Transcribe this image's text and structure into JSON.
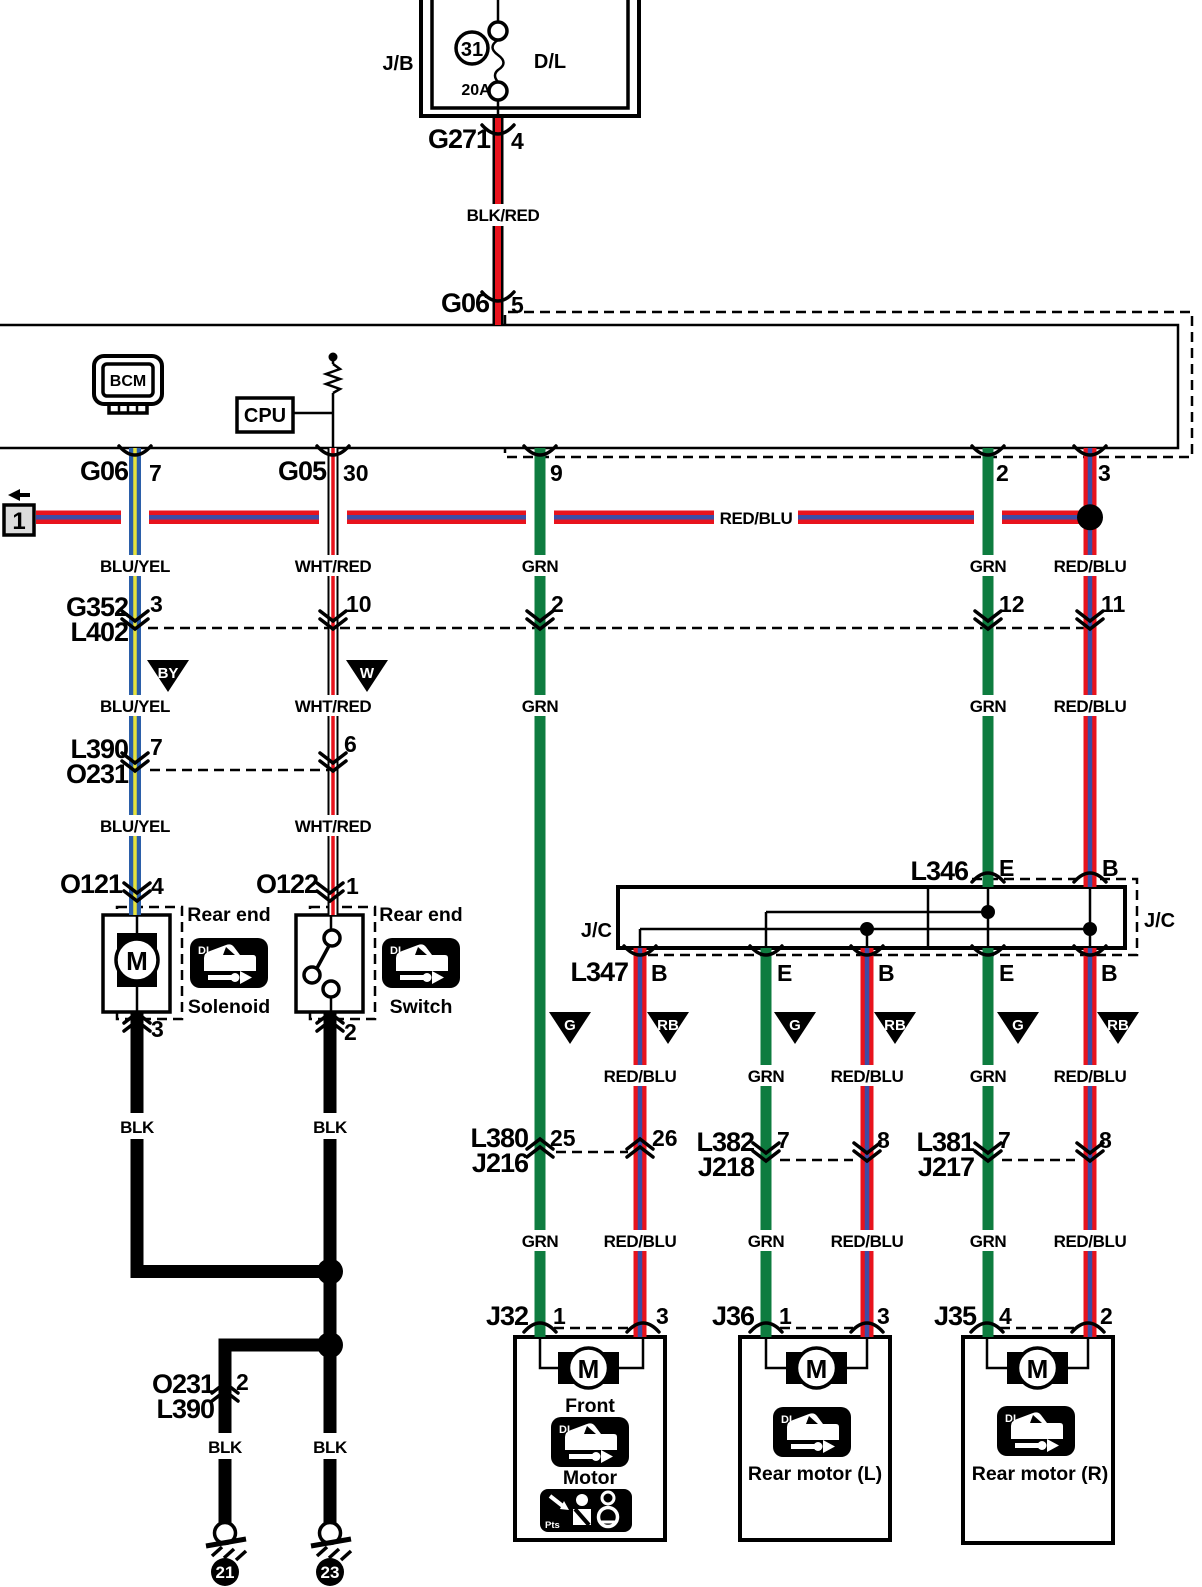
{
  "colors": {
    "green": "#0e7c3f",
    "red": "#e8131d",
    "blue_stripe": "#3c4da6",
    "blue": "#2b5fa9",
    "yellow": "#e7e33b",
    "ref_box_fill": "#dcdcdc"
  },
  "wires": {
    "blk_red": "BLK/RED",
    "blu_yel": "BLU/YEL",
    "wht_red": "WHT/RED",
    "grn": "GRN",
    "red_blu": "RED/BLU",
    "blk": "BLK"
  },
  "codes": {
    "by": "BY",
    "w": "W",
    "g": "G",
    "rb": "RB"
  },
  "fuse_panel": {
    "panel": "J/B",
    "fuse_number": "31",
    "rating": "20A",
    "circuit": "D/L"
  },
  "feed": {
    "connector_top": "G271",
    "pin_top": "4",
    "connector_bottom": "G06",
    "pin_bottom": "5"
  },
  "bcm": {
    "module": "BCM",
    "cpu": "CPU"
  },
  "bcm_pins": {
    "g06": "G06",
    "g06_pin": "7",
    "g05": "G05",
    "g05_pin": "30",
    "pin_9": "9",
    "pin_2": "2",
    "pin_3": "3"
  },
  "bus": {
    "ref": "1"
  },
  "conn_g352": {
    "row1": "G352",
    "row2": "L402",
    "pins": [
      "3",
      "10",
      "2",
      "12",
      "11"
    ]
  },
  "conn_l390": {
    "row1": "L390",
    "row2": "O231",
    "pins": [
      "7",
      "6"
    ]
  },
  "solenoid": {
    "connector": "O121",
    "pin_in": "4",
    "pin_out": "3",
    "motor": "M",
    "caption_top": "Rear end",
    "caption_bottom": "Solenoid",
    "dl": "DL"
  },
  "door_switch": {
    "connector": "O122",
    "pin_in": "1",
    "pin_out": "2",
    "caption_top": "Rear end",
    "caption_bottom": "Switch",
    "dl": "DL"
  },
  "junction": {
    "top": "L346",
    "bottom": "L347",
    "jc_left": "J/C",
    "jc_right": "J/C",
    "pins_top": [
      "E",
      "B"
    ],
    "pins_bottom": [
      "B",
      "E",
      "B",
      "E",
      "B"
    ]
  },
  "conn_l380": {
    "row1": "L380",
    "row2": "J216",
    "pins": [
      "25",
      "26"
    ]
  },
  "conn_l382": {
    "row1": "L382",
    "row2": "J218",
    "pins": [
      "7",
      "8"
    ]
  },
  "conn_l381": {
    "row1": "L381",
    "row2": "J217",
    "pins": [
      "7",
      "8"
    ]
  },
  "front_motor": {
    "connector": "J32",
    "pin_left": "1",
    "pin_right": "3",
    "motor": "M",
    "caption1": "Front",
    "caption2": "Motor",
    "dl": "DL",
    "icon_text": "Pts"
  },
  "rear_motor_l": {
    "connector": "J36",
    "pin_left": "1",
    "pin_right": "3",
    "motor": "M",
    "caption": "Rear motor (L)",
    "dl": "DL"
  },
  "rear_motor_r": {
    "connector": "J35",
    "pin_left": "4",
    "pin_right": "2",
    "motor": "M",
    "caption": "Rear motor (R)",
    "dl": "DL"
  },
  "ground_branch": {
    "row1": "O231",
    "row2": "L390",
    "pin": "2"
  },
  "grounds": {
    "left": "21",
    "right": "23"
  }
}
